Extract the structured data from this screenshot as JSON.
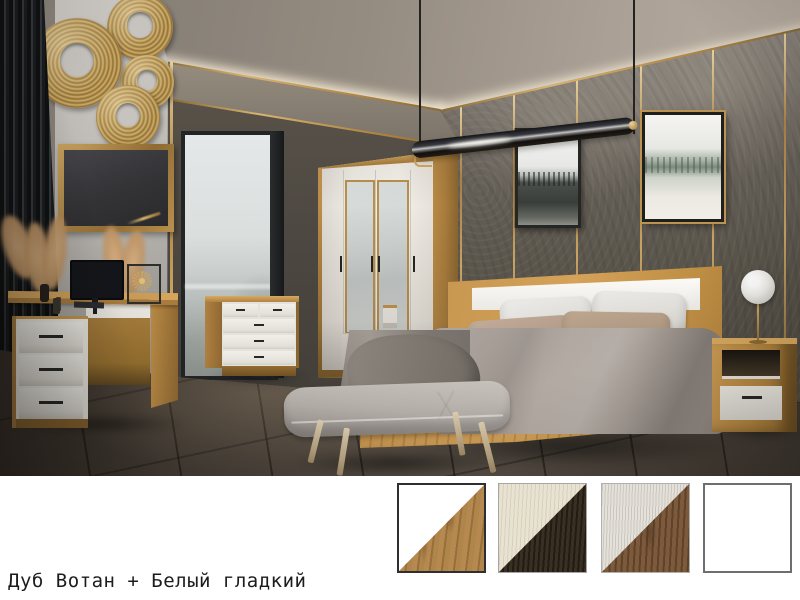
{
  "caption": {
    "text": "Дуб Вотан + Белый гладкий"
  },
  "finish_swatches": {
    "items": [
      {
        "id": "oak-wotan-white",
        "texture": "oak-wotan",
        "primary": "#ffffff",
        "secondary": "#b5894f",
        "border": "#2f2f2f",
        "border_width": 2,
        "selected": true
      },
      {
        "id": "cream-wood-wenge",
        "texture": "wenge",
        "primary": "#e8e2d1",
        "secondary": "#3a2f23",
        "border": "#a6a6a6",
        "border_width": 1,
        "selected": false
      },
      {
        "id": "whitewash-walnut",
        "texture": "walnut",
        "primary": "#e4e1da",
        "secondary": "#7d5a3c",
        "border": "#b0b0b0",
        "border_width": 1,
        "selected": false
      },
      {
        "id": "plain-white",
        "texture": "none",
        "primary": "#ffffff",
        "secondary": "#ffffff",
        "border": "#6e6e6e",
        "border_width": 2,
        "selected": false
      }
    ]
  },
  "palette": {
    "oak": "#c1914d",
    "oak_dark": "#936c31",
    "white_furniture": "#f0ede7",
    "wall_concrete": "#5d5751",
    "wall_warm_gray": "#c7c4bf",
    "slat_black": "#15171a",
    "floor": "#4a423a",
    "gold": "#c3a05c",
    "ceiling": "#958d83",
    "cove_light": "#f6ecd6",
    "bedding_gray": "#a79e98",
    "pillow_taupe": "#b59e8c",
    "bench_gray": "#b3ada9",
    "sky": "#dfe3e3"
  },
  "scene": {
    "items": [
      "four-door-wardrobe",
      "double-bed",
      "chest-of-drawers",
      "writing-desk",
      "bedside-table-left",
      "bedside-table-right",
      "upholstered-bench",
      "wall-mirror",
      "gold-disc-wall-decor",
      "pendant-lamp",
      "sphere-table-lamp-left",
      "sphere-table-lamp-right",
      "framed-art-forest-bw",
      "framed-art-winter-forest",
      "monitor",
      "pampas-grass",
      "window"
    ]
  }
}
